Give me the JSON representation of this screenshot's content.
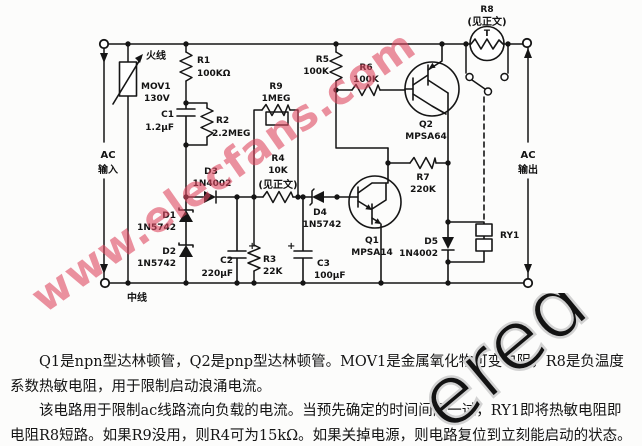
{
  "schematic": {
    "wire_labels": {
      "live": "火线",
      "neutral": "中线",
      "ac_in_1": "AC",
      "ac_in_2": "输入",
      "ac_out_1": "AC",
      "ac_out_2": "输出"
    },
    "components": {
      "mov1": {
        "ref": "MOV1",
        "value": "130V"
      },
      "r1": {
        "ref": "R1",
        "value": "100KΩ"
      },
      "c1": {
        "ref": "C1",
        "value": "1.2μF"
      },
      "r2": {
        "ref": "R2",
        "value": "2.2MEG"
      },
      "r9": {
        "ref": "R9",
        "value": "1MEG"
      },
      "r4": {
        "ref": "R4",
        "value": "10K",
        "note": "(见正文)"
      },
      "d3": {
        "ref": "D3",
        "value": "1N4002"
      },
      "d1": {
        "ref": "D1",
        "value": "1N5742"
      },
      "d2": {
        "ref": "D2",
        "value": "1N5742"
      },
      "c2": {
        "ref": "C2",
        "value": "220μF",
        "polarity": "+"
      },
      "r3": {
        "ref": "R3",
        "value": "22K"
      },
      "c3": {
        "ref": "C3",
        "value": "100μF",
        "polarity": "+"
      },
      "d4": {
        "ref": "D4",
        "value": "1N5742"
      },
      "q1": {
        "ref": "Q1",
        "value": "MPSA14"
      },
      "q2": {
        "ref": "Q2",
        "value": "MPSA64"
      },
      "r5": {
        "ref": "R5",
        "value": "100K"
      },
      "r6": {
        "ref": "R6",
        "value": "100K"
      },
      "r7": {
        "ref": "R7",
        "value": "220K"
      },
      "d5": {
        "ref": "D5",
        "value": "1N4002"
      },
      "ry1": {
        "ref": "RY1"
      },
      "r8": {
        "ref": "R8",
        "note": "(见正文)",
        "symbol_letter": "T"
      }
    }
  },
  "watermarks": {
    "site": "www.elecfans.com",
    "corner": "ered"
  },
  "description": {
    "para1": "Q1是npn型达林顿管，Q2是pnp型达林顿管。MOV1是金属氧化物可变电阻，R8是负温度系数热敏电阻，用于限制启动浪涌电流。",
    "para2": "该电路用于限制ac线路流向负载的电流。当预先确定的时间间隔一过，RY1即将热敏电阻即电阻R8短路。如果R9没用，则R4可为15kΩ。如果关掉电源，则电路复位到立刻能启动的状态。"
  }
}
